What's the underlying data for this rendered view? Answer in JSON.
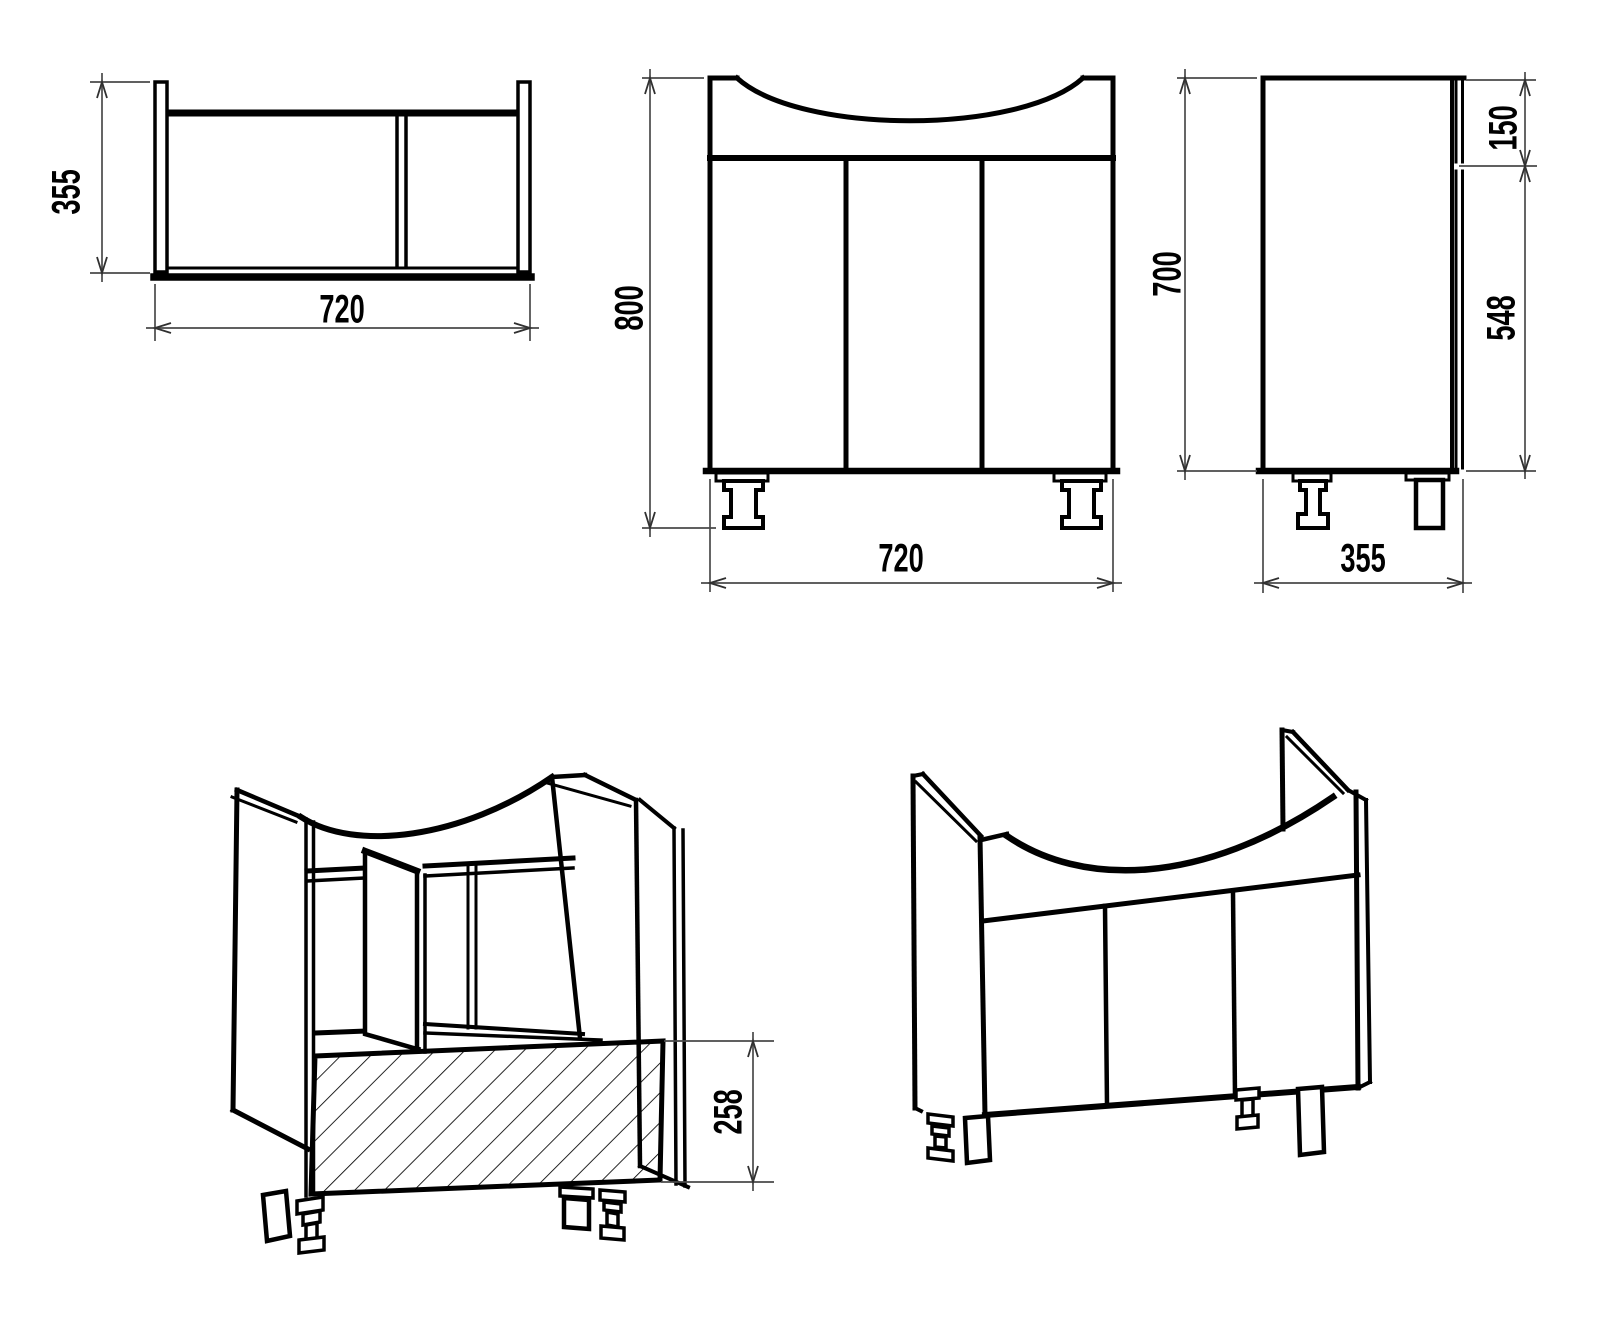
{
  "page": {
    "background": "#ffffff",
    "line_color": "#000000",
    "dimension_line_color": "#4a4a4a",
    "text_color": "#000000"
  },
  "views": {
    "top": {
      "depth": "355",
      "width": "720"
    },
    "front": {
      "height": "800",
      "width": "720"
    },
    "side": {
      "height": "700",
      "top_section": "150",
      "door_height": "548",
      "depth": "355"
    },
    "iso_open": {
      "base_height": "258"
    },
    "iso_closed": {}
  }
}
